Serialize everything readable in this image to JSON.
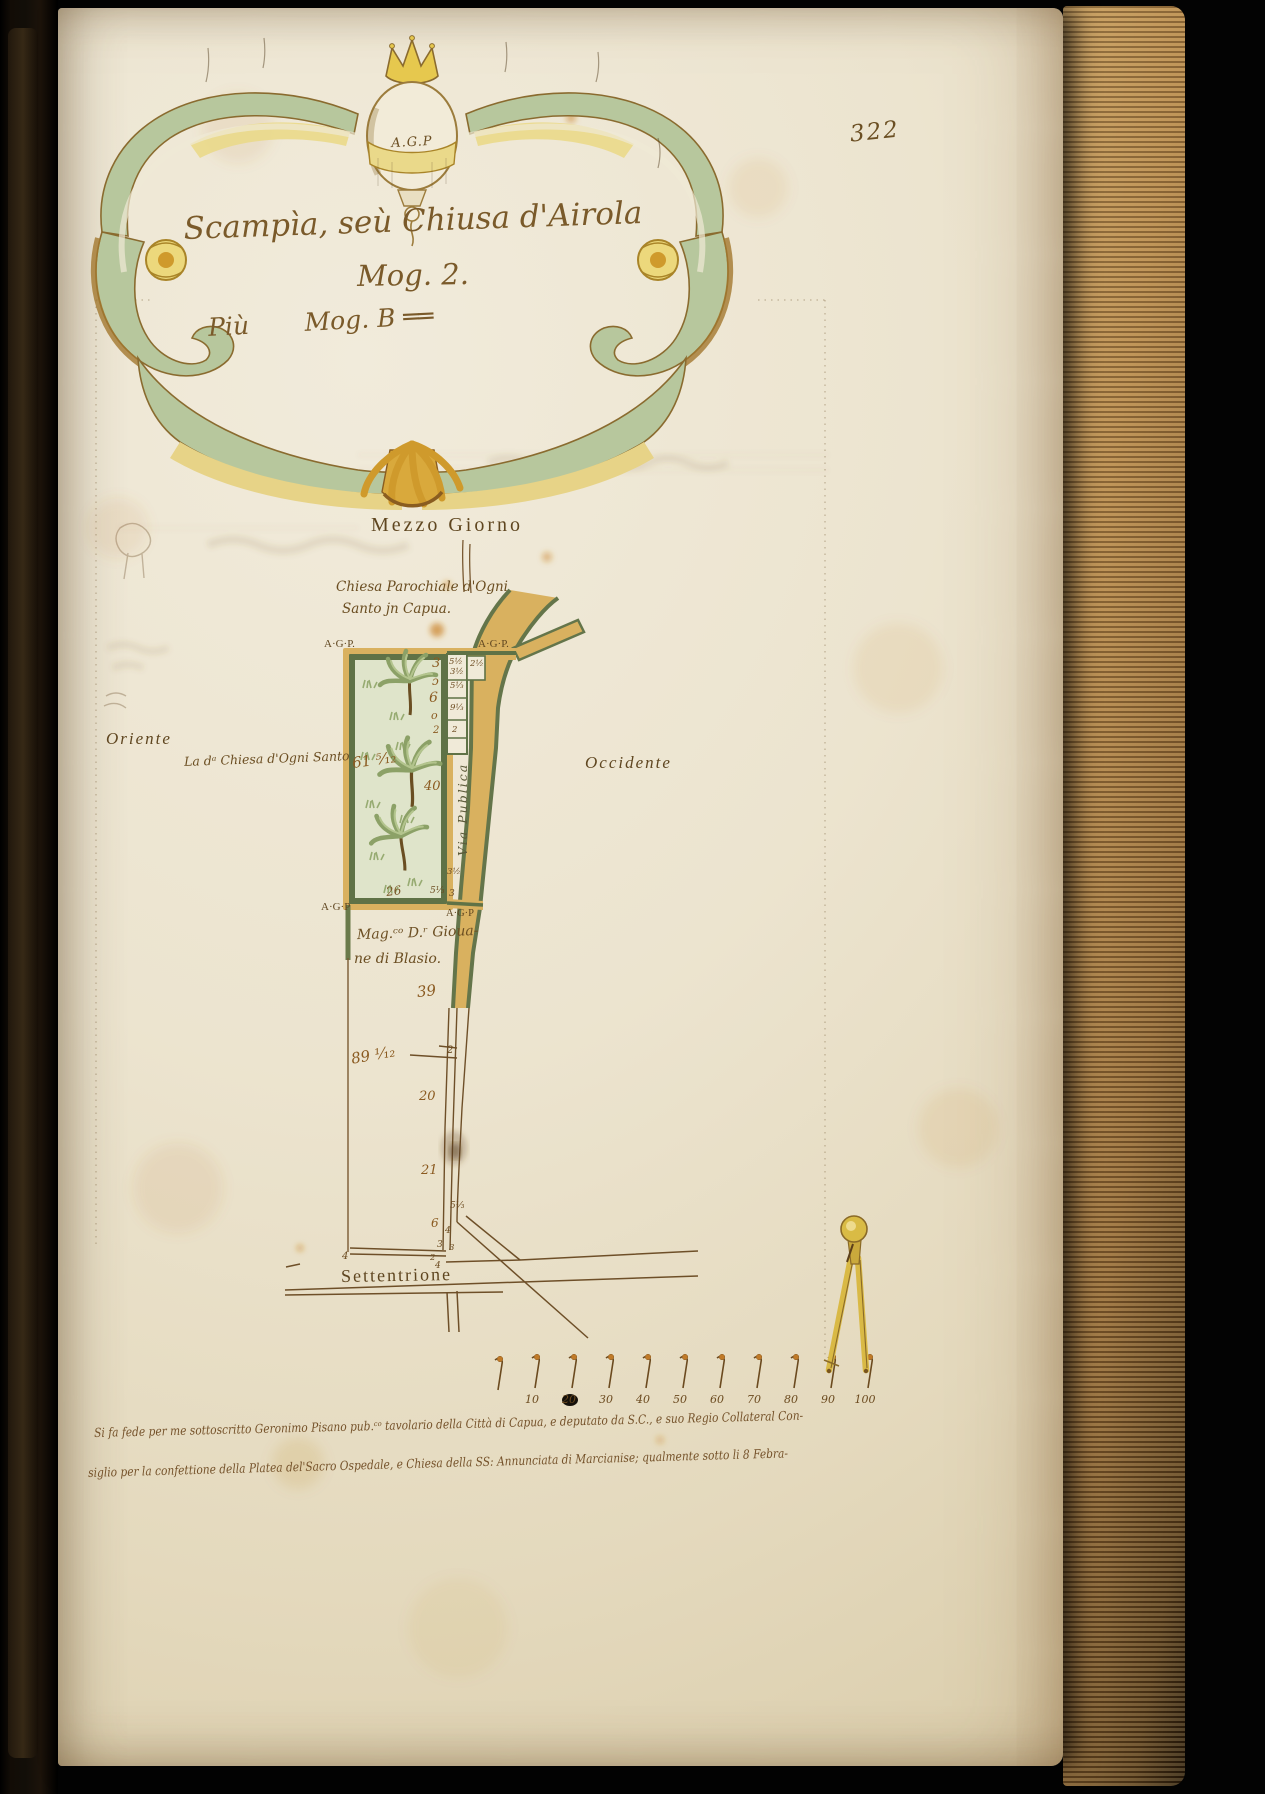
{
  "page_number": "322",
  "cartouche": {
    "monogram": "A.G.P",
    "title": "Scampìa, seù Chiusa d'Airola",
    "subtitle": "Mog. 2.",
    "subline": "Più       Mog. B ══"
  },
  "map": {
    "cardinals": {
      "south": "Mezzo Giorno",
      "east": "Oriente",
      "west": "Occidente",
      "north": "Settentrione"
    },
    "labels": {
      "church_line1": "Chiesa Parochiale d'Ogni",
      "church_line2": "Santo jn Capua.",
      "church_adjacent": "La dᵃ Chiesa d'Ogni Santo",
      "road": "Via Publica",
      "owner_line1": "Mag.ᶜᵒ D.ʳ Gioua-",
      "owner_line2": "ne di Blasio.",
      "corner_tl": "A·G·P.",
      "corner_tr": "A·G·P.",
      "corner_bl": "A·G·P",
      "corner_br": "A·G·P"
    },
    "measurements": {
      "edge_col": [
        "3",
        "ɔ",
        "6",
        "o",
        "2"
      ],
      "cells": [
        "5½",
        "3½",
        "2½",
        "5⅓",
        "9⅓",
        "2"
      ],
      "area_main": "61 ⁵⁄₁₂",
      "right_mid": "40",
      "bottom": "26",
      "bottom_b": "5⅓",
      "bottom_c": "3",
      "corner_small": "3½",
      "below": "39",
      "strip_area": "89 ¹⁄₁₂",
      "strip_tick": "2",
      "strip_mid": "20",
      "strip_low": "21",
      "junction": [
        "5⅓",
        "6",
        "4",
        "3",
        "3",
        "2",
        "4",
        "4"
      ]
    }
  },
  "scale_bar": {
    "labels": [
      "10",
      "20",
      "30",
      "40",
      "50",
      "60",
      "70",
      "80",
      "90",
      "100"
    ]
  },
  "attestation": {
    "line1": "Si fa fede per me sottoscritto Geronimo Pisano pub.ᶜᵒ tavolario della Città di Capua, e deputato da S.C., e suo Regio Collateral Con-",
    "line2": "siglio per la confettione della Platea del'Sacro Ospedale, e Chiesa della SS: Annunciata di Marcianise; qualmente sotto li 8 Febra-"
  }
}
